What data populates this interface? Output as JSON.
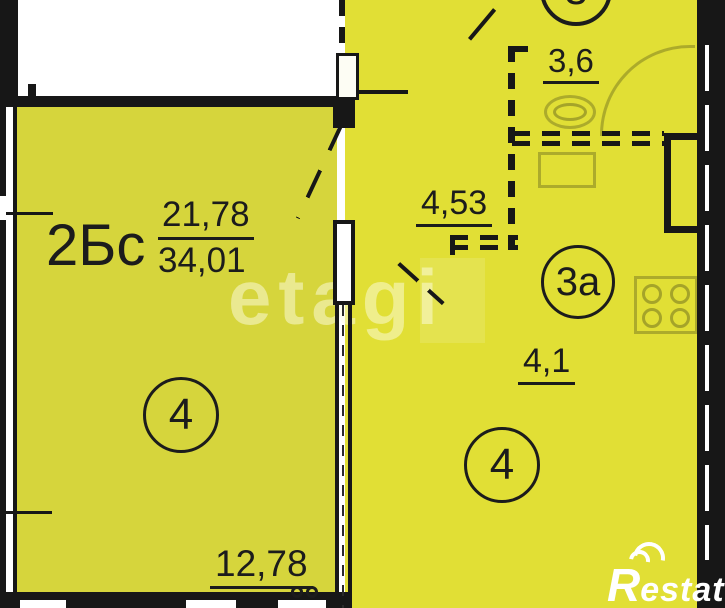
{
  "floorplan": {
    "apartment": {
      "type_label": "2Бс",
      "living_area": "21,78",
      "total_area": "34,01"
    },
    "room_circles": {
      "top": "3",
      "bath": "3а",
      "left_room": "4",
      "right_room": "4"
    },
    "dimensions": {
      "bath_width": "3,6",
      "hall_width": "4,53",
      "wc_width": "4,1",
      "room_width": "12,78"
    },
    "watermark": "etagi",
    "brand": {
      "initial": "R",
      "rest": "estate"
    },
    "colors": {
      "room_fill_left": "#d6d53c",
      "room_fill_right": "#e1df35",
      "wall": "#171717",
      "background": "#ffffff"
    }
  }
}
